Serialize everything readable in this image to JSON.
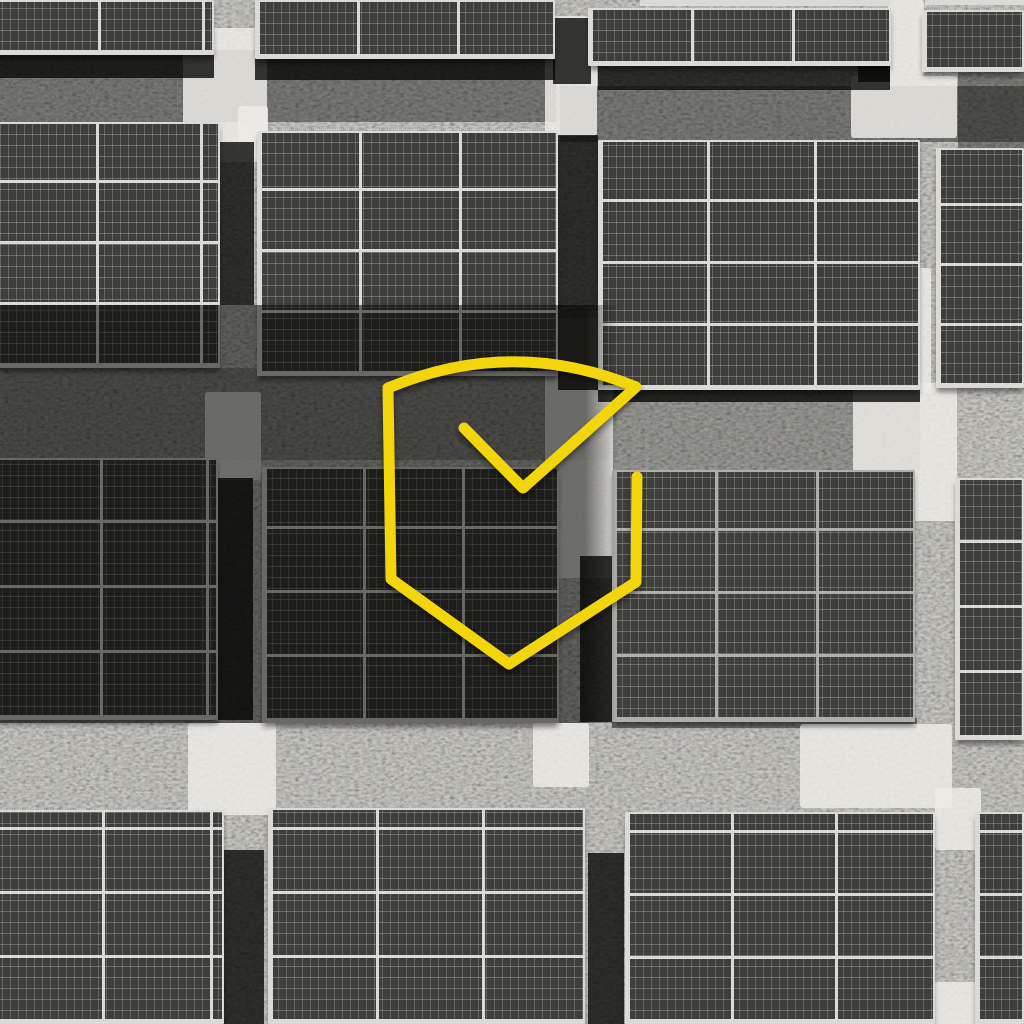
{
  "scene": {
    "size": {
      "w": 1024,
      "h": 1024
    },
    "colors": {
      "grass_base": "#c6c5c0",
      "panel_cell": "#3e3e3c",
      "panel_cell_line_v": "rgba(215,215,210,0.25)",
      "panel_cell_line_h": "rgba(215,215,210,0.30)",
      "frame_bright": "#dcdad4",
      "frame_mid": "#b0b0ab",
      "concrete": "rgba(236,235,230,0.85)",
      "shadow": "rgba(8,8,6,0.80)",
      "grass_shade": "rgba(14,14,11,1)",
      "overlay_dark": "rgba(0,0,0,0.52)",
      "accent_yellow": "#F2D60B"
    },
    "grass_shades": [
      [
        0,
        50,
        556,
        72,
        0.42
      ],
      [
        560,
        86,
        464,
        56,
        0.42
      ],
      [
        958,
        72,
        66,
        80,
        0.4
      ],
      [
        0,
        368,
        612,
        92,
        0.25
      ],
      [
        613,
        390,
        307,
        80,
        0.25
      ],
      [
        612,
        718,
        305,
        10,
        0.45
      ]
    ],
    "concrete_patches": [
      [
        183,
        28,
        84,
        134
      ],
      [
        238,
        106,
        30,
        52
      ],
      [
        545,
        16,
        52,
        120
      ],
      [
        851,
        76,
        106,
        62
      ],
      [
        888,
        0,
        36,
        76
      ],
      [
        903,
        268,
        28,
        124
      ],
      [
        853,
        383,
        104,
        138
      ],
      [
        188,
        723,
        88,
        92
      ],
      [
        533,
        723,
        56,
        64
      ],
      [
        800,
        724,
        152,
        84
      ],
      [
        935,
        788,
        46,
        62
      ],
      [
        925,
        982,
        52,
        42
      ],
      [
        545,
        318,
        68,
        260
      ],
      [
        205,
        392,
        56,
        88
      ]
    ],
    "shadow_patches": [
      [
        216,
        142,
        38,
        163
      ],
      [
        553,
        18,
        38,
        66
      ],
      [
        558,
        135,
        40,
        255
      ],
      [
        215,
        478,
        38,
        242
      ],
      [
        580,
        556,
        33,
        166
      ],
      [
        222,
        850,
        42,
        174
      ],
      [
        588,
        853,
        36,
        171
      ],
      [
        0,
        52,
        214,
        26
      ],
      [
        255,
        58,
        300,
        22
      ],
      [
        598,
        66,
        292,
        24
      ],
      [
        598,
        388,
        322,
        14
      ],
      [
        858,
        56,
        32,
        26
      ]
    ],
    "frame_strips": [
      [
        640,
        0,
        250,
        6
      ],
      [
        925,
        0,
        99,
        5
      ]
    ],
    "panel_groups": [
      [
        -8,
        0,
        222,
        55,
        104,
        62,
        "bright"
      ],
      [
        255,
        0,
        300,
        59,
        100,
        62,
        "bright"
      ],
      [
        588,
        8,
        303,
        58,
        101,
        62,
        "bright"
      ],
      [
        922,
        10,
        102,
        62,
        104,
        64,
        "bright"
      ],
      [
        -10,
        122,
        230,
        246,
        104,
        61,
        "bright"
      ],
      [
        257,
        131,
        301,
        245,
        100,
        61,
        "bright"
      ],
      [
        598,
        140,
        322,
        250,
        107,
        62,
        "bright"
      ],
      [
        936,
        148,
        88,
        240,
        90,
        60,
        "bright"
      ],
      [
        -8,
        458,
        226,
        262,
        106,
        65,
        "bright"
      ],
      [
        262,
        467,
        297,
        256,
        99,
        64,
        "bright"
      ],
      [
        612,
        470,
        303,
        252,
        101,
        63,
        "mid"
      ],
      [
        955,
        478,
        69,
        262,
        70,
        65,
        "bright"
      ],
      [
        -8,
        810,
        232,
        214,
        108,
        64,
        "bright"
      ],
      [
        268,
        808,
        317,
        216,
        106,
        64,
        "bright"
      ],
      [
        625,
        812,
        310,
        212,
        104,
        63,
        "bright"
      ],
      [
        975,
        812,
        49,
        212,
        50,
        63,
        "bright"
      ]
    ],
    "overlay_band": {
      "x": 0,
      "y": 305,
      "width": 618,
      "height": 418,
      "solid_until": 585,
      "color": "rgba(0,0,0,0.52)"
    },
    "logo": {
      "name": "shield-check",
      "color": "#F2D60B",
      "stroke_width": 11,
      "path": "M 464 428 L 523 488 L 636 387 Q 512 336 388 388 L 391 579 L 509 664 L 636 582 L 637 477"
    }
  }
}
